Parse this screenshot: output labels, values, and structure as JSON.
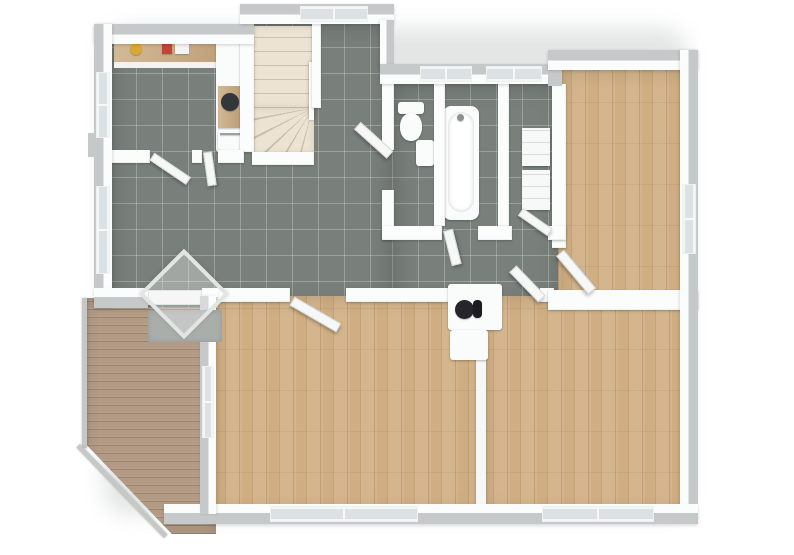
{
  "scene": {
    "kind": "3d-floor-plan-render",
    "canvas": {
      "width": 794,
      "height": 555,
      "background": "#ffffff"
    }
  },
  "palette": {
    "tile_floor": "#79807b",
    "wood_floor": "#cfae83",
    "deck_wood": "#b29a84",
    "wall_white": "#fbfcfc",
    "wall_cap_gray": "#c6c9ca",
    "stairs_cream": "#ece3d2",
    "window_glass": "#dce2e4",
    "doormat_gray": "#a9aeab",
    "counter_wood": "#c9a97e",
    "sink_dark": "#33363a",
    "flue_black": "#26262a",
    "item_yellow": "#d9a832",
    "item_red": "#c24538"
  },
  "rooms": [
    {
      "id": "kitchen",
      "floor": "tile"
    },
    {
      "id": "entrance-hall",
      "floor": "tile"
    },
    {
      "id": "hallway-corridor",
      "floor": "tile"
    },
    {
      "id": "wc",
      "floor": "tile"
    },
    {
      "id": "bathroom",
      "floor": "tile"
    },
    {
      "id": "utility-room",
      "floor": "tile"
    },
    {
      "id": "bedroom-top-right",
      "floor": "wood"
    },
    {
      "id": "living-room",
      "floor": "wood"
    },
    {
      "id": "bedroom-bottom-right",
      "floor": "wood"
    },
    {
      "id": "deck-terrace",
      "floor": "deck"
    },
    {
      "id": "staircase",
      "floor": "stairs"
    }
  ],
  "elements": [
    {
      "name": "house-shadow",
      "cls": "shadow-blur",
      "x": 104,
      "y": 28,
      "w": 582,
      "h": 486
    },
    {
      "name": "deck-floor",
      "cls": "deck",
      "x": 86,
      "y": 298,
      "w": 130,
      "h": 236,
      "clip": "polygon(0 0,100% 0,100% 100%,66% 100%,0 62%)"
    },
    {
      "name": "deck-railing-left",
      "cls": "rail",
      "x": 82,
      "y": 298,
      "w": 5,
      "h": 150
    },
    {
      "name": "deck-railing-diagonal",
      "cls": "rail",
      "x": 80,
      "y": 444,
      "w": 126,
      "h": 5,
      "rot": 46,
      "origin": "0 0"
    },
    {
      "name": "kitchen-hall-tile-floor",
      "cls": "tile",
      "x": 110,
      "y": 24,
      "w": 282,
      "h": 284
    },
    {
      "name": "corridor-bath-tile-floor",
      "cls": "tile",
      "x": 392,
      "y": 84,
      "w": 170,
      "h": 224
    },
    {
      "name": "bedroom1-wood-floor",
      "cls": "wood",
      "x": 558,
      "y": 70,
      "w": 136,
      "h": 238
    },
    {
      "name": "living-room-wood-floor",
      "cls": "wood",
      "x": 212,
      "y": 296,
      "w": 270,
      "h": 218
    },
    {
      "name": "bedroom2-wood-floor",
      "cls": "wood",
      "x": 480,
      "y": 296,
      "w": 214,
      "h": 218
    },
    {
      "name": "staircase-straight-flight",
      "cls": "stairs",
      "x": 252,
      "y": 26,
      "w": 62,
      "h": 82
    },
    {
      "name": "staircase-winder",
      "cls": "winder",
      "x": 252,
      "y": 108,
      "w": 62,
      "h": 46
    },
    {
      "name": "staircase-handrail",
      "cls": "rail-white",
      "x": 309,
      "y": 62,
      "w": 5,
      "h": 58
    },
    {
      "name": "kitchen-counter-top",
      "cls": "counter",
      "x": 114,
      "y": 40,
      "w": 126,
      "h": 22
    },
    {
      "name": "kitchen-counter-front",
      "cls": "white-face",
      "x": 114,
      "y": 62,
      "w": 126,
      "h": 6
    },
    {
      "name": "kitchen-item-yellow-bowl",
      "cls": "dot",
      "x": 130,
      "y": 43,
      "w": 12,
      "h": 12,
      "fill": "#d9a832"
    },
    {
      "name": "kitchen-item-red-appliance",
      "cls": "chip",
      "x": 162,
      "y": 42,
      "w": 10,
      "h": 12,
      "fill": "#c24538"
    },
    {
      "name": "kitchen-item-white-appliance",
      "cls": "chip",
      "x": 175,
      "y": 42,
      "w": 14,
      "h": 12,
      "fill": "#f4f4f2"
    },
    {
      "name": "kitchen-cabinet-column",
      "cls": "fixture",
      "x": 216,
      "y": 40,
      "w": 28,
      "h": 112
    },
    {
      "name": "kitchen-counter-sink-section",
      "cls": "counter",
      "x": 218,
      "y": 86,
      "w": 24,
      "h": 42
    },
    {
      "name": "kitchen-sink-basin",
      "cls": "dot",
      "x": 221,
      "y": 93,
      "w": 18,
      "h": 18,
      "fill": "#33363a"
    },
    {
      "name": "kitchen-oven",
      "cls": "fixture",
      "x": 218,
      "y": 130,
      "w": 24,
      "h": 20
    },
    {
      "name": "kitchen-oven-handle",
      "cls": "chip",
      "x": 220,
      "y": 133,
      "w": 20,
      "h": 2,
      "fill": "#9aa0a4"
    },
    {
      "name": "toilet-tank",
      "cls": "fixture",
      "x": 398,
      "y": 102,
      "w": 26,
      "h": 12
    },
    {
      "name": "toilet-bowl",
      "cls": "fixture round",
      "x": 400,
      "y": 113,
      "w": 22,
      "h": 28
    },
    {
      "name": "wc-corner-sink",
      "cls": "fixture",
      "x": 416,
      "y": 140,
      "w": 18,
      "h": 26
    },
    {
      "name": "bathtub-outer",
      "cls": "fixture",
      "x": 443,
      "y": 106,
      "w": 36,
      "h": 114,
      "radius": 8
    },
    {
      "name": "bathtub-inner",
      "cls": "tub-inner",
      "x": 448,
      "y": 112,
      "w": 26,
      "h": 100
    },
    {
      "name": "bathtub-faucet",
      "cls": "dot",
      "x": 457,
      "y": 114,
      "w": 7,
      "h": 7,
      "fill": "#8c9094"
    },
    {
      "name": "utility-shelf-upper",
      "cls": "shelf",
      "x": 522,
      "y": 128,
      "w": 28,
      "h": 38
    },
    {
      "name": "utility-shelf-lower",
      "cls": "shelf",
      "x": 522,
      "y": 170,
      "w": 28,
      "h": 40
    },
    {
      "name": "wall-kitchen-stairs",
      "cls": "wall",
      "x": 240,
      "y": 40,
      "w": 14,
      "h": 112
    },
    {
      "name": "wall-stairs-east",
      "cls": "wall",
      "x": 312,
      "y": 24,
      "w": 9,
      "h": 84
    },
    {
      "name": "wall-stairs-south",
      "cls": "wall",
      "x": 252,
      "y": 152,
      "w": 62,
      "h": 13
    },
    {
      "name": "wall-kitchen-south-a",
      "cls": "wall",
      "x": 112,
      "y": 150,
      "w": 38,
      "h": 13
    },
    {
      "name": "wall-kitchen-south-post",
      "cls": "wall",
      "x": 192,
      "y": 150,
      "w": 10,
      "h": 13
    },
    {
      "name": "wall-kitchen-south-b",
      "cls": "wall",
      "x": 218,
      "y": 150,
      "w": 26,
      "h": 13
    },
    {
      "name": "wall-wc-west",
      "cls": "wall",
      "x": 382,
      "y": 84,
      "w": 12,
      "h": 66
    },
    {
      "name": "wall-wc-west-post",
      "cls": "wall",
      "x": 382,
      "y": 190,
      "w": 12,
      "h": 50
    },
    {
      "name": "wall-wc-bath",
      "cls": "wall",
      "x": 434,
      "y": 84,
      "w": 11,
      "h": 142
    },
    {
      "name": "wall-bath-utility",
      "cls": "wall",
      "x": 498,
      "y": 84,
      "w": 11,
      "h": 142
    },
    {
      "name": "wall-utility-bedroom1",
      "cls": "wall",
      "x": 552,
      "y": 84,
      "w": 14,
      "h": 164
    },
    {
      "name": "wall-corridor-north-a",
      "cls": "wall",
      "x": 382,
      "y": 226,
      "w": 60,
      "h": 14
    },
    {
      "name": "wall-corridor-north-b",
      "cls": "wall",
      "x": 478,
      "y": 226,
      "w": 34,
      "h": 14
    },
    {
      "name": "wall-corridor-north-c",
      "cls": "wall",
      "x": 548,
      "y": 226,
      "w": 18,
      "h": 14
    },
    {
      "name": "wall-corridor-south-a",
      "cls": "wall",
      "x": 212,
      "y": 288,
      "w": 78,
      "h": 14
    },
    {
      "name": "wall-corridor-south-b",
      "cls": "wall",
      "x": 346,
      "y": 288,
      "w": 104,
      "h": 14
    },
    {
      "name": "wall-corridor-south-post",
      "cls": "wall",
      "x": 540,
      "y": 288,
      "w": 14,
      "h": 14
    },
    {
      "name": "wall-bedrooms-divider",
      "cls": "wall",
      "x": 548,
      "y": 290,
      "w": 150,
      "h": 20
    },
    {
      "name": "wall-living-bedroom2",
      "cls": "wall-thin",
      "x": 476,
      "y": 300,
      "w": 10,
      "h": 210
    },
    {
      "name": "door-kitchen",
      "cls": "door",
      "x": 152,
      "y": 152,
      "w": 44,
      "h": 9,
      "rot": 34,
      "origin": "0 50%"
    },
    {
      "name": "door-kitchen-2",
      "cls": "door",
      "x": 203,
      "y": 152,
      "w": 9,
      "h": 34,
      "rot": -8,
      "origin": "50% 0"
    },
    {
      "name": "door-wc",
      "cls": "door",
      "x": 346,
      "y": 150,
      "w": 44,
      "h": 10,
      "rot": 42,
      "origin": "100% 50%"
    },
    {
      "name": "door-bathroom",
      "cls": "door",
      "x": 443,
      "y": 230,
      "w": 10,
      "h": 36,
      "rot": -14,
      "origin": "50% 0"
    },
    {
      "name": "door-utility",
      "cls": "door",
      "x": 514,
      "y": 228,
      "w": 36,
      "h": 9,
      "rot": 35,
      "origin": "100% 50%"
    },
    {
      "name": "door-bedroom1",
      "cls": "door",
      "x": 560,
      "y": 248,
      "w": 50,
      "h": 10,
      "rot": 50,
      "origin": "0 50%"
    },
    {
      "name": "door-bedroom2",
      "cls": "door",
      "x": 500,
      "y": 294,
      "w": 42,
      "h": 10,
      "rot": 46,
      "origin": "100% 50%"
    },
    {
      "name": "door-living-room",
      "cls": "door",
      "x": 292,
      "y": 296,
      "w": 54,
      "h": 10,
      "rot": 30,
      "origin": "0 50%"
    },
    {
      "name": "wall-ext-kitchen-north",
      "cls": "ext-top",
      "x": 94,
      "y": 24,
      "w": 160,
      "h": 20
    },
    {
      "name": "wall-ext-stairs-north",
      "cls": "ext-top",
      "x": 240,
      "y": 4,
      "w": 154,
      "h": 20
    },
    {
      "name": "window-stairs-north",
      "cls": "win-h",
      "x": 300,
      "y": 6,
      "w": 68,
      "h": 16
    },
    {
      "name": "wall-ext-stairs-east",
      "cls": "ext-right",
      "x": 380,
      "y": 20,
      "w": 14,
      "h": 48
    },
    {
      "name": "wall-ext-bath-north",
      "cls": "ext-top",
      "x": 380,
      "y": 64,
      "w": 182,
      "h": 20
    },
    {
      "name": "window-bath-north-1",
      "cls": "win-h",
      "x": 420,
      "y": 66,
      "w": 52,
      "h": 16
    },
    {
      "name": "window-bath-north-2",
      "cls": "win-h",
      "x": 486,
      "y": 66,
      "w": 56,
      "h": 16
    },
    {
      "name": "wall-ext-bedroom1-west-connector",
      "cls": "cap",
      "x": 548,
      "y": 50,
      "w": 14,
      "h": 36
    },
    {
      "name": "wall-ext-bedroom1-north",
      "cls": "ext-top",
      "x": 548,
      "y": 50,
      "w": 150,
      "h": 20
    },
    {
      "name": "wall-ext-right",
      "cls": "ext-right",
      "x": 680,
      "y": 50,
      "w": 18,
      "h": 472
    },
    {
      "name": "window-bedroom1-east",
      "cls": "win-v",
      "x": 682,
      "y": 184,
      "w": 14,
      "h": 70
    },
    {
      "name": "wall-ext-south",
      "cls": "ext-bottom",
      "x": 164,
      "y": 504,
      "w": 534,
      "h": 20
    },
    {
      "name": "window-living-south",
      "cls": "win-h",
      "x": 270,
      "y": 506,
      "w": 148,
      "h": 16
    },
    {
      "name": "window-bedroom2-south",
      "cls": "win-h",
      "x": 542,
      "y": 506,
      "w": 112,
      "h": 16
    },
    {
      "name": "wall-ext-left",
      "cls": "ext-left",
      "x": 94,
      "y": 24,
      "w": 18,
      "h": 284
    },
    {
      "name": "window-kitchen-west",
      "cls": "win-v",
      "x": 96,
      "y": 72,
      "w": 14,
      "h": 66
    },
    {
      "name": "window-hall-west",
      "cls": "win-v",
      "x": 96,
      "y": 186,
      "w": 14,
      "h": 88
    },
    {
      "name": "exterior-pillar",
      "cls": "cap",
      "x": 88,
      "y": 133,
      "w": 8,
      "h": 24
    },
    {
      "name": "wall-ext-hall-south-a",
      "cls": "ext-bottom",
      "x": 94,
      "y": 288,
      "w": 54,
      "h": 20
    },
    {
      "name": "wall-ext-hall-south-b",
      "cls": "ext-bottom",
      "x": 202,
      "y": 288,
      "w": 16,
      "h": 20
    },
    {
      "name": "front-door",
      "cls": "door-slab",
      "x": 148,
      "y": 290,
      "w": 54,
      "h": 15
    },
    {
      "name": "wall-ext-living-west",
      "cls": "ext-left",
      "x": 200,
      "y": 296,
      "w": 16,
      "h": 218
    },
    {
      "name": "window-living-west",
      "cls": "win-v",
      "x": 202,
      "y": 366,
      "w": 12,
      "h": 72
    },
    {
      "name": "doormat",
      "cls": "mat",
      "x": 148,
      "y": 310,
      "w": 74,
      "h": 32
    },
    {
      "name": "entrance-canopy",
      "cls": "canopy",
      "x": 152,
      "y": 262,
      "w": 64,
      "h": 64,
      "rot": 45
    },
    {
      "name": "fireplace-block",
      "cls": "fixture",
      "x": 448,
      "y": 284,
      "w": 54,
      "h": 46
    },
    {
      "name": "fireplace-flue",
      "cls": "dot",
      "x": 455,
      "y": 300,
      "w": 19,
      "h": 19,
      "fill": "#26262a"
    },
    {
      "name": "fireplace-vent",
      "cls": "chip",
      "x": 473,
      "y": 300,
      "w": 9,
      "h": 18,
      "fill": "#1d1d20",
      "radius": 4
    },
    {
      "name": "fireplace-hearth",
      "cls": "fixture",
      "x": 450,
      "y": 330,
      "w": 38,
      "h": 30
    }
  ]
}
